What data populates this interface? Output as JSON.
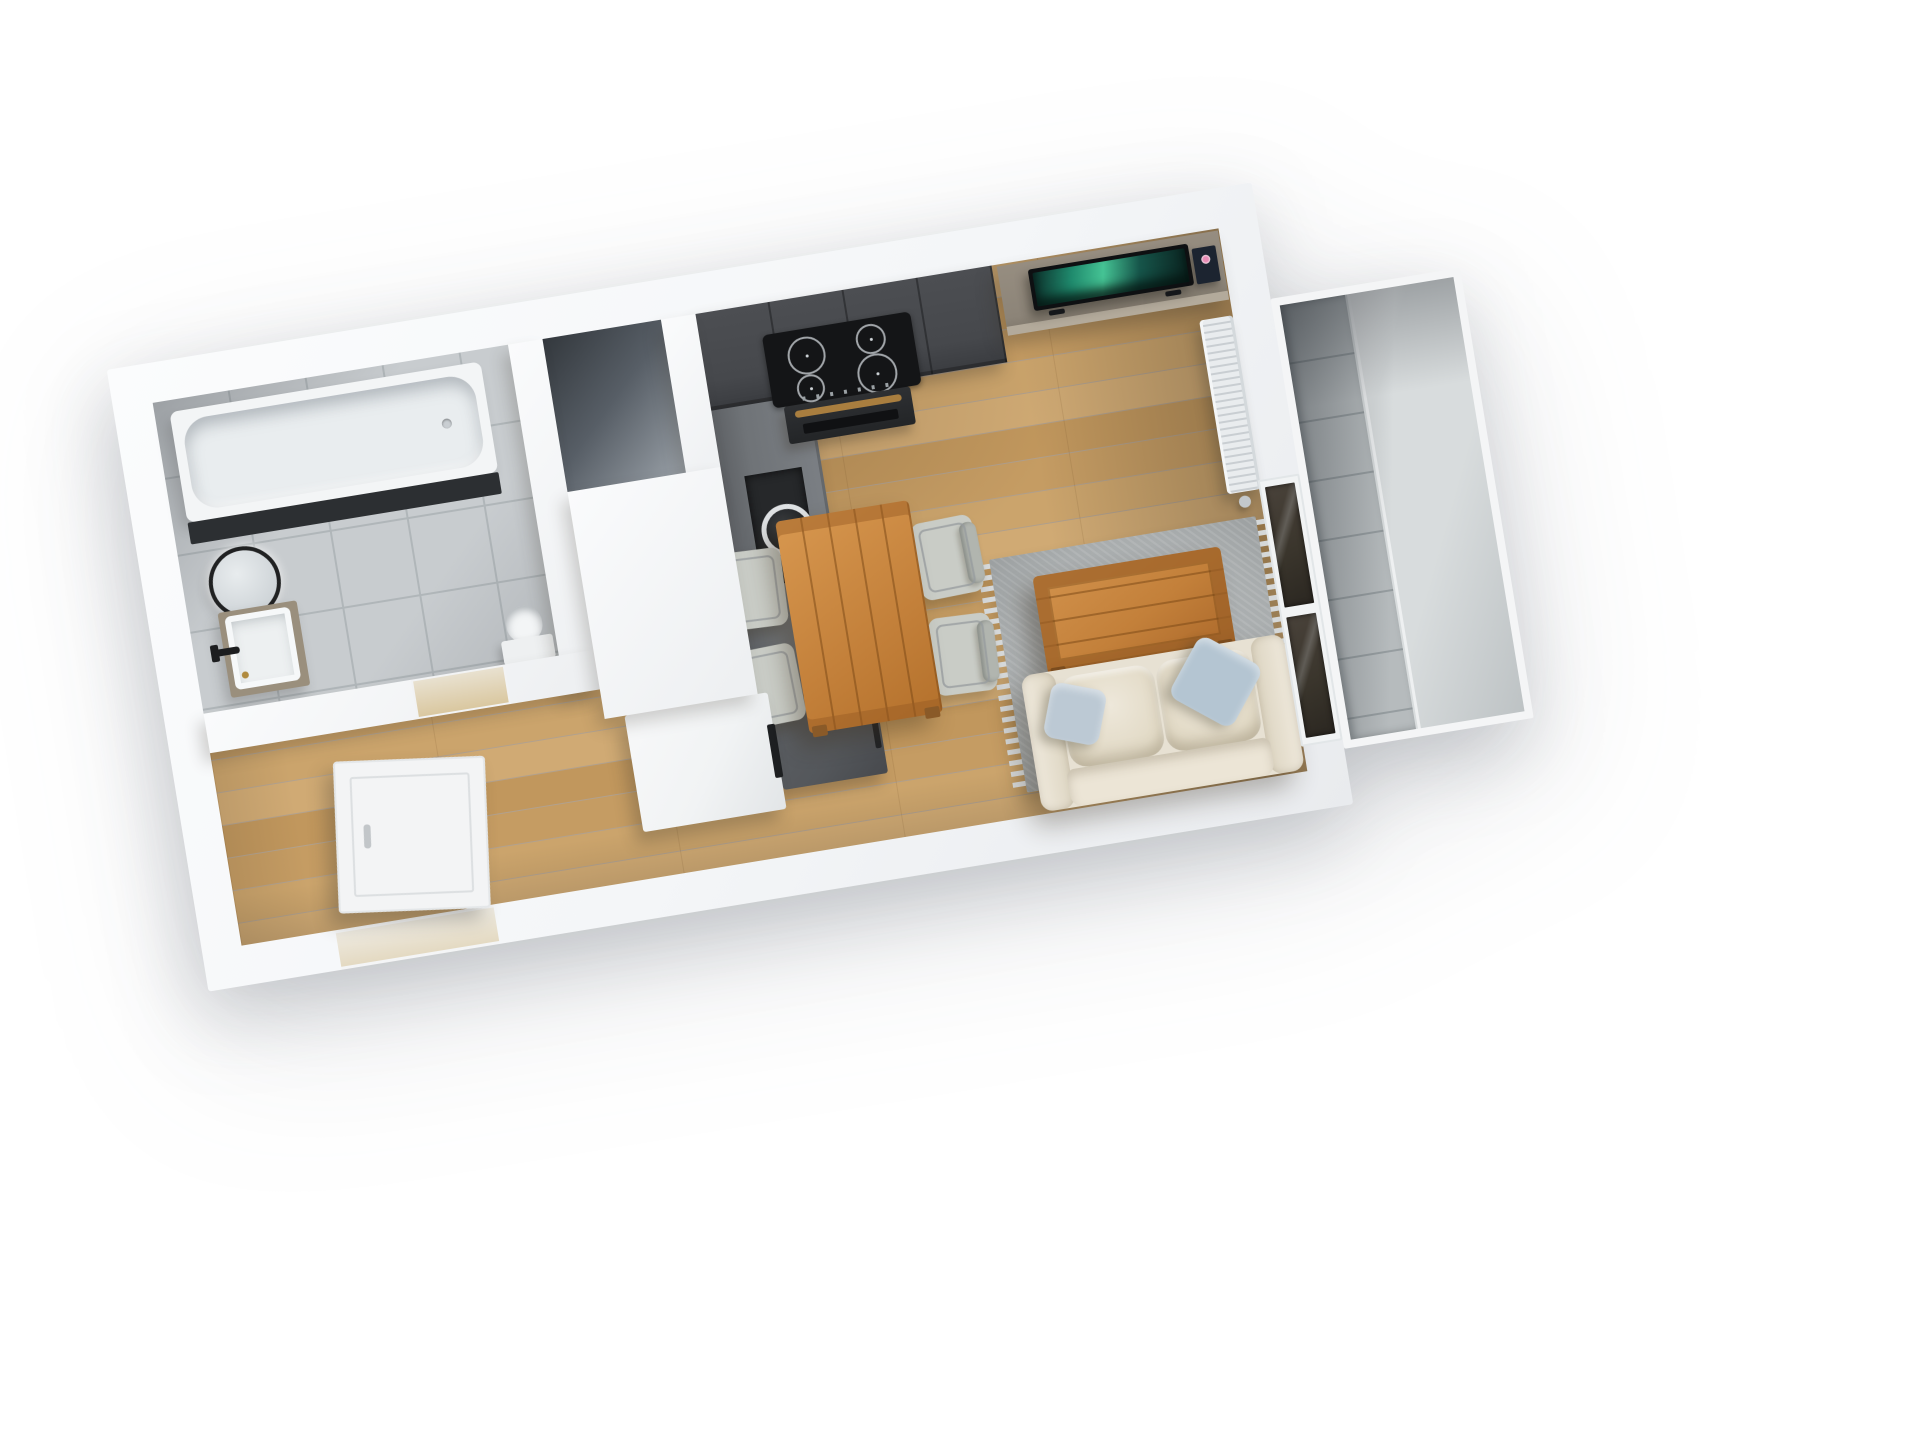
{
  "scene": {
    "title": "3D top-down floor plan render of a studio apartment with balcony",
    "view": "top-down 3D render",
    "background_color": "#ffffff",
    "plan_rotation_deg": -9.3
  },
  "colors": {
    "wallShade": "#e9ebee",
    "wood": "#c59c63",
    "woodLight": "#d0aa74",
    "woodDark": "#c1975d",
    "bathTile": "#c8cccf",
    "bathTileLine": "#b0b6b9",
    "nicheFloor": "#33383d",
    "tubWhite": "#f3f5f6",
    "tubApron": "#2c2f32",
    "cabCharcoal": "#46484c",
    "cooktopBlack": "#141517",
    "ovenHandle": "#a97e3f",
    "tallCab": "#6f7377",
    "washerDark": "#26282a",
    "applianceGray": "#54575b",
    "counterWhite": "#f1f3f4",
    "tvStand": "#8c8478",
    "tvBlack": "#0e1012",
    "tvScreenTeal": "#2aa07c",
    "radiatorWhite": "#e9ecee",
    "rugGray": "#a9adae",
    "rugFringe": "#d5d8d9",
    "furnWood": "#c3803a",
    "chairGray": "#c9ccc6",
    "sofaCream": "#e7e1d3",
    "pillowBlue": "#bcc9d4",
    "windowGlass": "#3a352c",
    "balconyTile": "#b6bbbd",
    "balconyGlass": "#d8dcdd",
    "doorWhite": "#f3f4f5"
  },
  "rooms": [
    {
      "id": "bathroom",
      "name": "Bathroom",
      "floor": "gray ceramic tile"
    },
    {
      "id": "closet",
      "name": "Closet niche",
      "floor": "dark concrete"
    },
    {
      "id": "hallway",
      "name": "Hallway",
      "floor": "oak plank"
    },
    {
      "id": "kitchen",
      "name": "Kitchen",
      "floor": "oak plank"
    },
    {
      "id": "living",
      "name": "Living and dining room",
      "floor": "oak plank"
    },
    {
      "id": "balcony",
      "name": "Balcony",
      "floor": "concrete tile with glass railing"
    }
  ],
  "furniture": [
    {
      "id": "bathtub",
      "name": "Bathtub",
      "room": "bathroom"
    },
    {
      "id": "round-mirror",
      "name": "Round wall mirror",
      "room": "bathroom"
    },
    {
      "id": "vanity-sink",
      "name": "Vanity washbasin with black faucet",
      "room": "bathroom"
    },
    {
      "id": "toilet",
      "name": "Toilet",
      "room": "bathroom"
    },
    {
      "id": "kitchen-upper-cabinets",
      "name": "Charcoal kitchen cabinet run",
      "room": "kitchen"
    },
    {
      "id": "induction-cooktop",
      "name": "Induction cooktop with 4 burners",
      "room": "kitchen"
    },
    {
      "id": "oven",
      "name": "Built-in oven with brass handle",
      "room": "kitchen"
    },
    {
      "id": "tall-cabinet-washer",
      "name": "Tall cabinet with integrated washing machine",
      "room": "kitchen"
    },
    {
      "id": "refrigerator-cabinet",
      "name": "Gray appliance cabinet",
      "room": "kitchen"
    },
    {
      "id": "white-counter",
      "name": "White counter block",
      "room": "kitchen"
    },
    {
      "id": "dining-table",
      "name": "Wooden dining table",
      "room": "living"
    },
    {
      "id": "dining-chair",
      "name": "Gray dining chair",
      "room": "living"
    },
    {
      "id": "area-rug",
      "name": "Gray fringed area rug",
      "room": "living"
    },
    {
      "id": "coffee-table",
      "name": "Wooden coffee table",
      "room": "living"
    },
    {
      "id": "sofa",
      "name": "Cream two-seat sofa",
      "room": "living"
    },
    {
      "id": "throw-pillow",
      "name": "Light blue throw pillow",
      "room": "living"
    },
    {
      "id": "tv-stand",
      "name": "Gray wood TV stand",
      "room": "living"
    },
    {
      "id": "tv",
      "name": "Flat-screen TV showing teal aurora image",
      "room": "living"
    },
    {
      "id": "book",
      "name": "Book on TV stand",
      "room": "living"
    },
    {
      "id": "radiator",
      "name": "White panel radiator",
      "room": "living"
    },
    {
      "id": "entrance-door",
      "name": "Open white entrance door",
      "room": "hallway"
    },
    {
      "id": "window-doors",
      "name": "Dark glass window doors to balcony",
      "room": "living"
    },
    {
      "id": "balcony-glass",
      "name": "Balcony glass railing",
      "room": "balcony"
    }
  ]
}
